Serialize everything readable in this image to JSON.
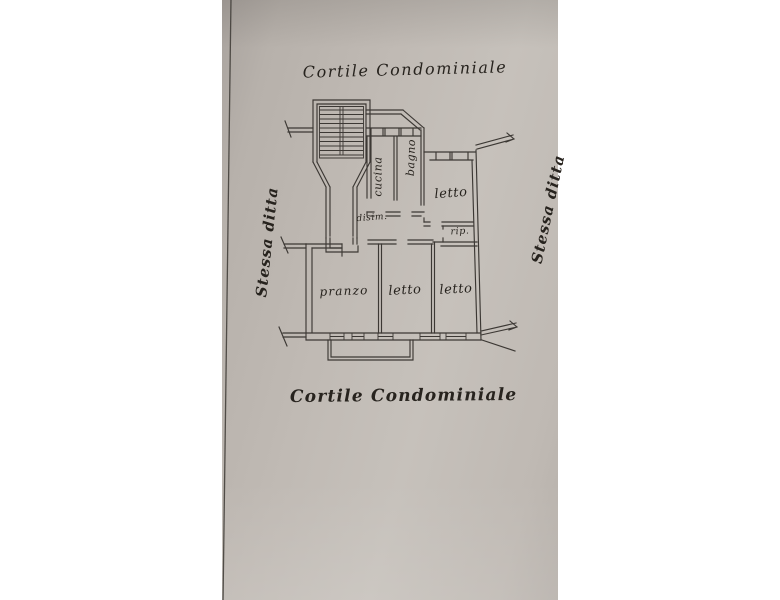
{
  "colors": {
    "paper": "#bfb9b3",
    "ink": "#3c3834",
    "handwriting": "#27231e"
  },
  "annotations": {
    "courtyard_top": "Cortile Condominiale",
    "courtyard_bottom": "Cortile Condominiale",
    "boundary_left": "Stessa ditta",
    "boundary_right": "Stessa ditta"
  },
  "rooms": {
    "cucina": "cucina",
    "bagno": "bagno",
    "letto_top": "letto",
    "rip": "rip.",
    "disim": "disim.",
    "pranzo": "pranzo",
    "letto_mid": "letto",
    "letto_right": "letto"
  }
}
